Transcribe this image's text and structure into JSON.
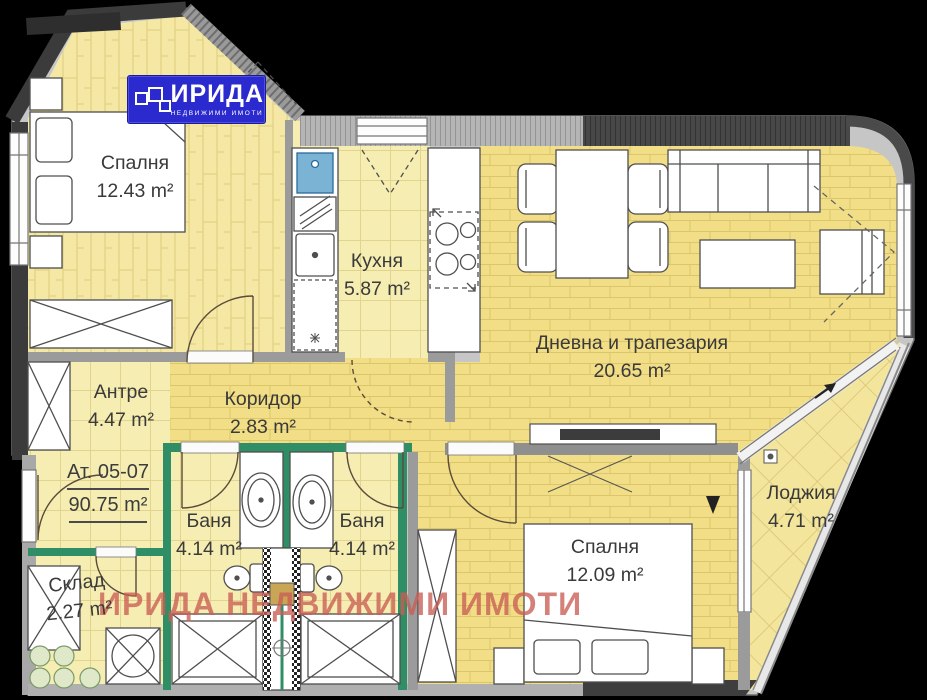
{
  "logo": {
    "brand": "ИРИДА",
    "tagline": "НЕДВИЖИМИ ИМОТИ"
  },
  "watermark": "ИРИДА НЕДВИЖИМИ ИМОТИ",
  "apartment": {
    "unit_label": "Ат. 05-07",
    "total_area": "90.75 m²"
  },
  "rooms": [
    {
      "id": "bedroom-1",
      "name": "Спалня",
      "area": "12.43 m²"
    },
    {
      "id": "kitchen",
      "name": "Кухня",
      "area": "5.87 m²"
    },
    {
      "id": "living-dining",
      "name": "Дневна и трапезария",
      "area": "20.65 m²"
    },
    {
      "id": "entry-hall",
      "name": "Антре",
      "area": "4.47 m²"
    },
    {
      "id": "corridor",
      "name": "Коридор",
      "area": "2.83 m²"
    },
    {
      "id": "bathroom-1",
      "name": "Баня",
      "area": "4.14 m²"
    },
    {
      "id": "bathroom-2",
      "name": "Баня",
      "area": "4.14 m²"
    },
    {
      "id": "storage",
      "name": "Склад",
      "area": "2.27 m²"
    },
    {
      "id": "bedroom-2",
      "name": "Спалня",
      "area": "12.09 m²"
    },
    {
      "id": "loggia",
      "name": "Лоджия",
      "area": "4.71 m²"
    }
  ],
  "colors": {
    "logo_blue": "#2a2ace",
    "watermark_red": "#c95d55",
    "floor_yellow": "#f1de86",
    "wall_green": "#2f8e66",
    "wall_dark": "#3b3b3b"
  }
}
